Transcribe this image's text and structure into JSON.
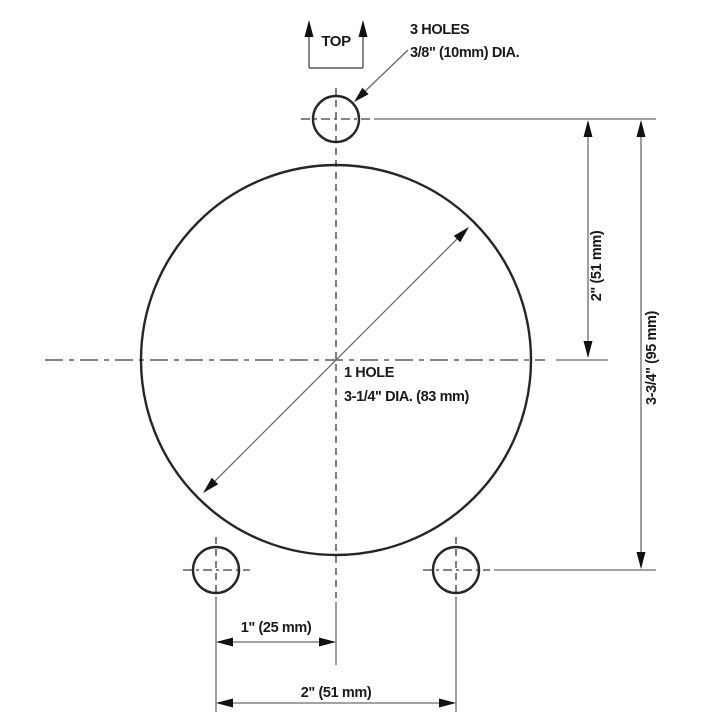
{
  "drawing": {
    "type": "technical-drilling-template",
    "orientation_label": "TOP",
    "callouts": {
      "small_holes": {
        "line1": "3 HOLES",
        "line2": "3/8\" (10mm) DIA."
      },
      "large_hole": {
        "line1": "1 HOLE",
        "line2": "3-1/4\" DIA. (83 mm)"
      }
    },
    "dimensions": {
      "top_hole_to_circle_center": "2\" (51 mm)",
      "top_hole_to_bottom_holes": "3-3/4\" (95 mm)",
      "center_to_left_hole": "1\" (25 mm)",
      "left_hole_to_right_hole": "2\" (51 mm)"
    },
    "colors": {
      "background": "#ffffff",
      "object_line": "#262626",
      "dimension_line": "#6b6b6b",
      "centerline": "#3a3a3a",
      "arrowhead": "#111111",
      "text": "#1a1a1a"
    }
  }
}
